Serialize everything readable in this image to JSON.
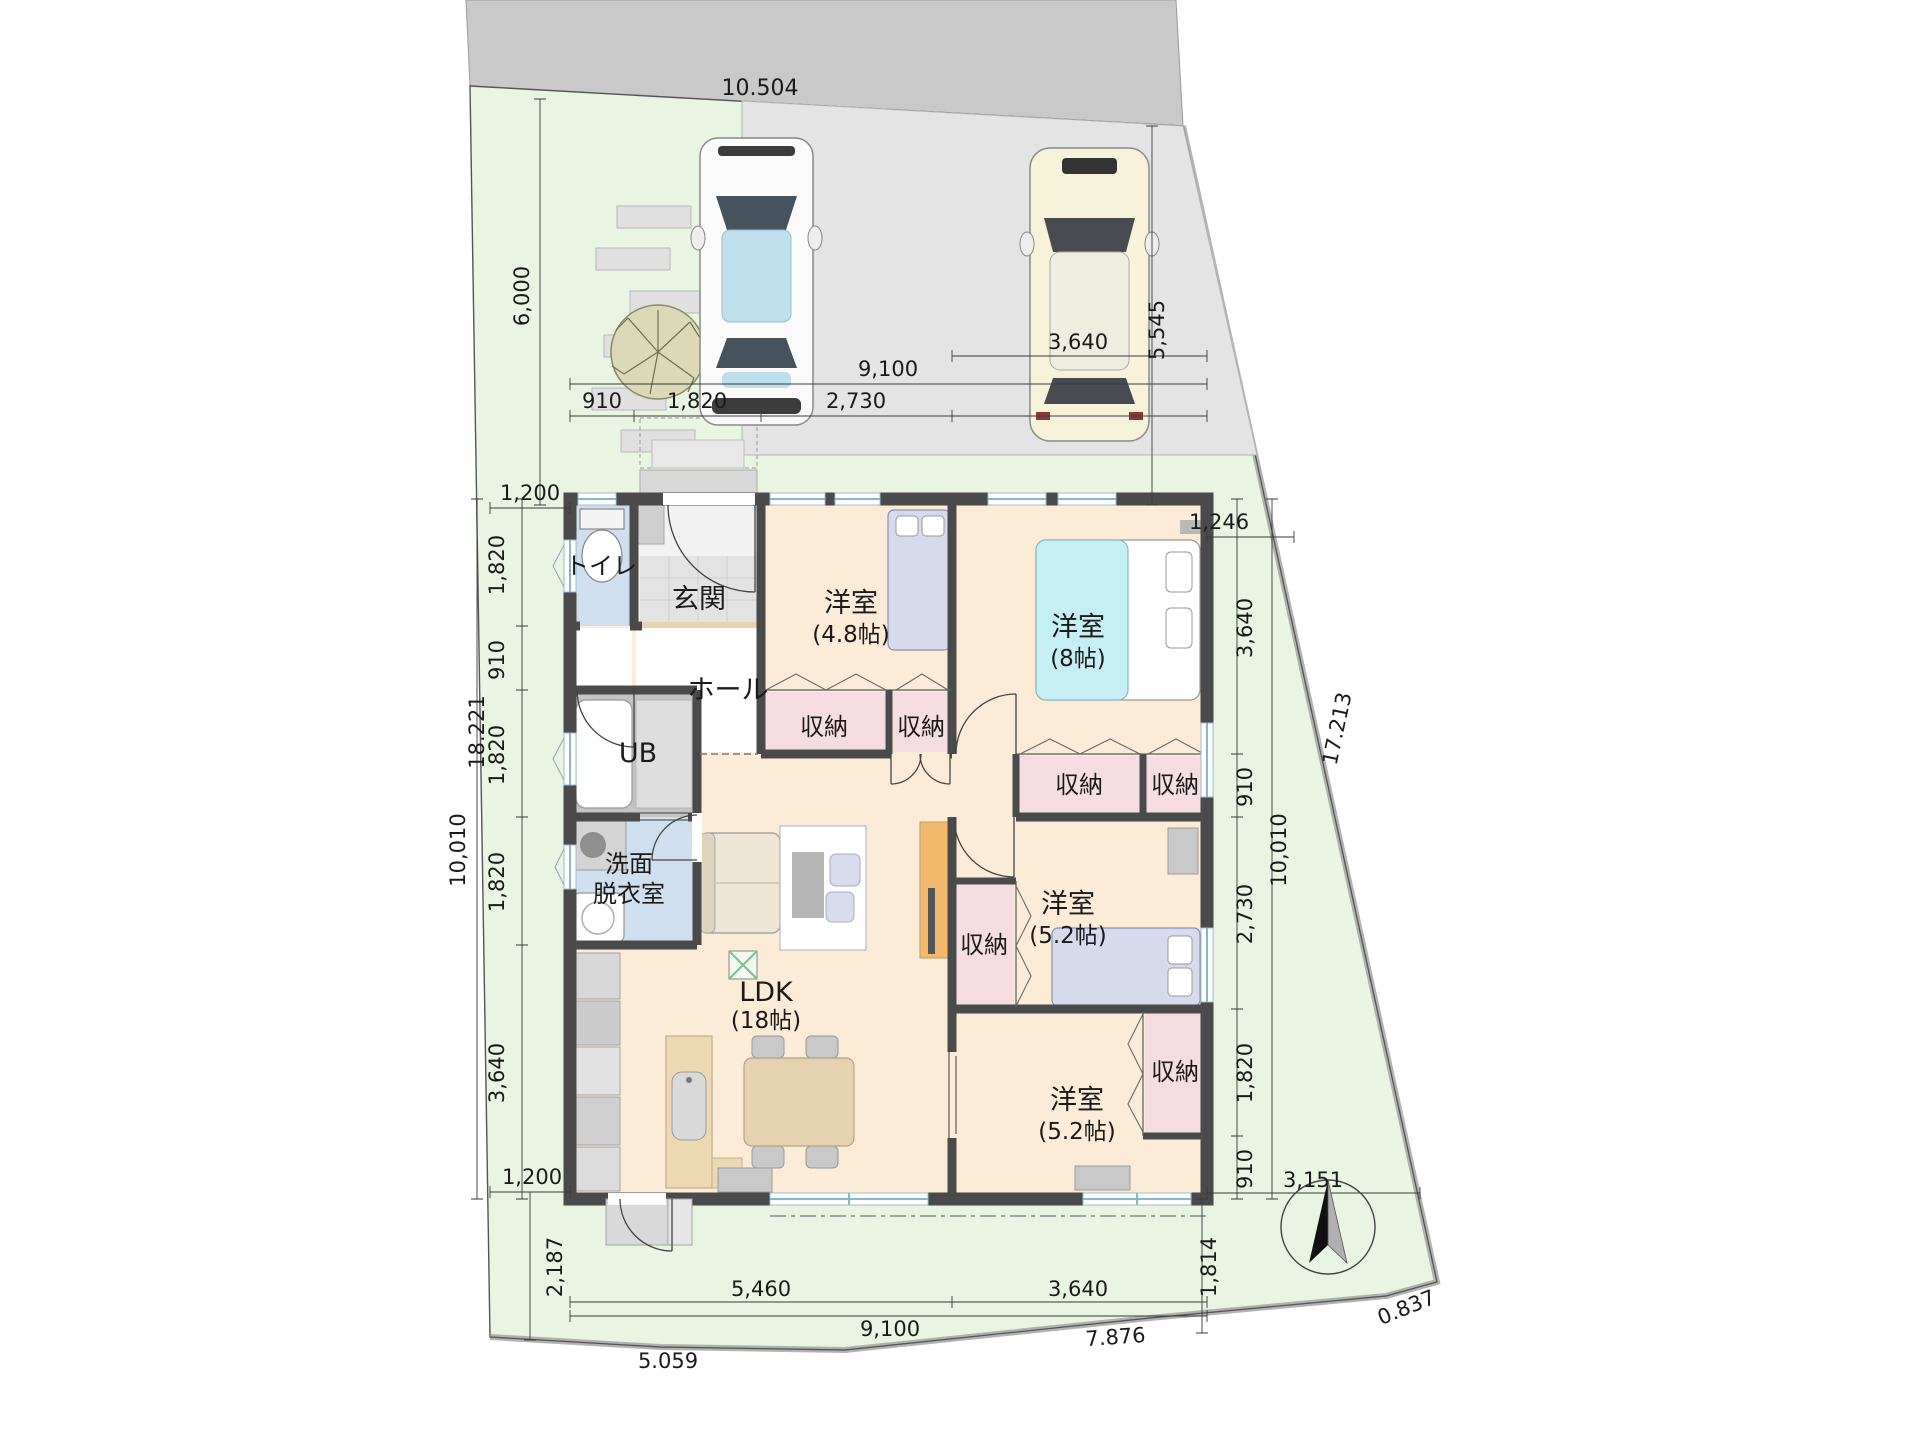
{
  "meta": {
    "type": "site-and-floor-plan",
    "canvas": {
      "width": 1920,
      "height": 1440
    }
  },
  "colors": {
    "site_green": "#e9f4e2",
    "road_gray": "#c9c9c9",
    "parking_gray": "#e4e4e4",
    "wall_dark": "#4a4a4a",
    "floor_wood": "#fcecd7",
    "tile_gray": "#e3e3e3",
    "wet_area_blue": "#cfdff0",
    "storage_pink": "#f6dde1",
    "bed_cyan": "#c5eef5",
    "bed_lavender": "#d6daec",
    "kitchen_tan": "#ecd9b4",
    "counter_orange": "#f0b96c",
    "tree_olive": "#dbd9b8"
  },
  "icons": {
    "compass": "north-arrow-icon",
    "tree": "tree-icon",
    "car_front": "car-top-view-icon",
    "car_rear": "car-top-view-icon",
    "floor_hatch": "floor-hatch-icon"
  },
  "rooms": {
    "toilet": "トイレ",
    "entrance": "玄関",
    "hall": "ホール",
    "bath": "UB",
    "washroom_1": "洗面",
    "washroom_2": "脱衣室",
    "ldk_name": "LDK",
    "ldk_size": "(18帖)",
    "bedroom_48_name": "洋室",
    "bedroom_48_size": "(4.8帖)",
    "bedroom_8_name": "洋室",
    "bedroom_8_size": "(8帖)",
    "bedroom_52a_name": "洋室",
    "bedroom_52a_size": "(5.2帖)",
    "bedroom_52b_name": "洋室",
    "bedroom_52b_size": "(5.2帖)",
    "storage": "収納"
  },
  "dims": {
    "road_frontage": "10.504",
    "garden_depth": "6,000",
    "parking_depth": "5,545",
    "top_overall": "9,100",
    "top_910": "910",
    "top_1820": "1,820",
    "top_2730": "2,730",
    "top_stall": "3,640",
    "ne_gap": "1,246",
    "nw_offset": "1,200",
    "west_boundary": "18.221",
    "left_1": "1,820",
    "left_2": "910",
    "left_3": "1,820",
    "left_4": "1,820",
    "left_5": "3,640",
    "left_overall": "10,010",
    "east_boundary": "17.213",
    "right_1": "3,640",
    "right_2": "910",
    "right_3": "2,730",
    "right_4": "1,820",
    "right_5": "910",
    "right_overall": "10,010",
    "se_gap": "3,151",
    "se_vert": "1,814",
    "sw_offset": "1,200",
    "sw_vert": "2,187",
    "bottom_1": "5,460",
    "bottom_2": "3,640",
    "bottom_overall": "9,100",
    "boundary_sw": "5.059",
    "boundary_s": "7.876",
    "boundary_se": "0.837"
  }
}
